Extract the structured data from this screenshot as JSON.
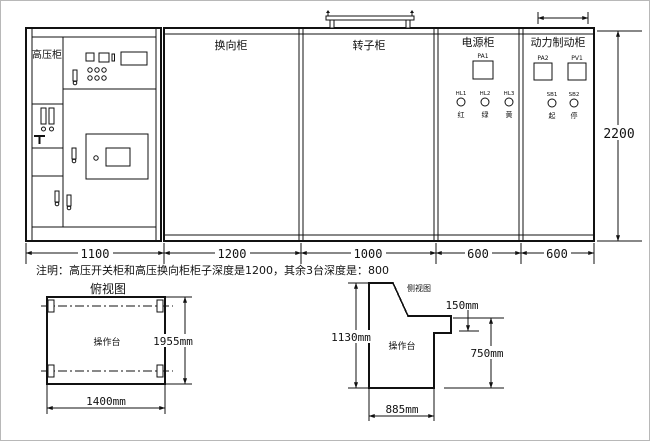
{
  "elevation": {
    "cabinets": {
      "hv": "高压柜",
      "reversing": "换向柜",
      "rotor": "转子柜",
      "power": "电源柜",
      "brake": "动力制动柜"
    },
    "power_cabinet": {
      "meter_label": "PA1",
      "lamps": [
        {
          "label": "HL1",
          "char": "红"
        },
        {
          "label": "HL2",
          "char": "绿"
        },
        {
          "label": "HL3",
          "char": "黄"
        }
      ]
    },
    "brake_cabinet": {
      "meters": [
        {
          "label": "PA2"
        },
        {
          "label": "PV1"
        }
      ],
      "buttons": [
        {
          "label": "SB1",
          "char": "起"
        },
        {
          "label": "SB2",
          "char": "停"
        }
      ]
    },
    "width_dims": [
      "1100",
      "1200",
      "1000",
      "600",
      "600"
    ],
    "height_dim": "2200"
  },
  "note": "注明：高压开关柜和高压换向柜柜子深度是1200，其余3台深度是：800",
  "plan_view": {
    "title": "俯视图",
    "label": "操作台",
    "dim_depth": "1955mm",
    "dim_width": "1400mm"
  },
  "side_view": {
    "title": "侧视图",
    "label": "操作台",
    "dim_height_total": "1130mm",
    "dim_step": "150mm",
    "dim_height_desk": "750mm",
    "dim_depth": "885mm"
  }
}
